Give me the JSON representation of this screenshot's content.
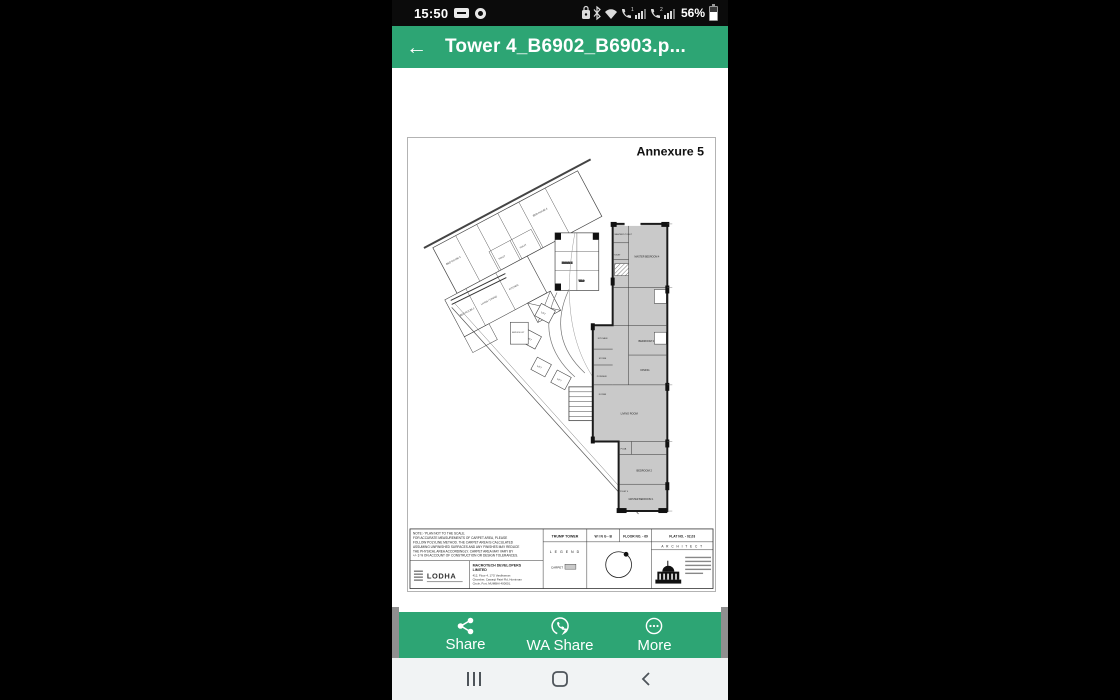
{
  "colors": {
    "accent_green": "#2da574",
    "plan_fill": "#c9c9c9"
  },
  "status_bar": {
    "time": "15:50",
    "battery": "56%",
    "sim1": "1",
    "sim2": "2"
  },
  "header": {
    "back_icon": "←",
    "title": "Tower 4_B6902_B6903.p..."
  },
  "action_bar": {
    "share": "Share",
    "wa_share": "WA Share",
    "more": "More"
  },
  "document": {
    "annexure": "Annexure 5",
    "note_lines": [
      "NOTE:- 'PLAN NOT TO THE SCALE.",
      "FOR ACCURATE MEASUREMENTS OF CARPET AREA, PLEASE",
      "FOLLOW POLYLINE METHOD. THE CARPET AREA IS CALCULATED",
      "ASSUMING UNFINISHED SURFACES AND ANY FINISHES MAY REDUCE",
      "THE PHYSICAL AREA ACCORDINGLY. CARPET AREA MAY VARY BY",
      "+/- 3 % ON ACCOUNT OF CONSTRUCTION OR DESIGN TOLERANCES."
    ],
    "title_block": {
      "project": "TRUMP TOWER",
      "wing": "W I N G - B",
      "floor": "FLOOR NO. - 69",
      "flat": "FLAT NO. -  02,03",
      "legend": "L E G E N D",
      "carpet": "CARPET",
      "architect": "A R C H I T E C T",
      "logo": "LODHA",
      "developer_1": "MACROTECH DEVELOPERS",
      "developer_2": "LIMITED",
      "address_1": "412, Floor 4, 17G Vardhaman",
      "address_2": "Chamber, Cawasji Patel Rd, Horniman",
      "address_3": "Circle, Fort, MUMBAI 400001."
    },
    "plan": {
      "bed_room_1": "BED ROOM 1",
      "bed_room_3": "BED ROOM 3",
      "bed_room_4": "BED ROOM 4",
      "toilet": "TOILET",
      "living_dining": "LIVING / DINING",
      "kitchen_left": "KITCHEN",
      "passage": "PASSAGE",
      "lift": "LIFT",
      "service_lift": "SERVICE LIFT",
      "wic": "W.I.C",
      "master_toilet": "MASTER'S TOILET",
      "master_bedroom_4": "MASTER BEDROOM 4",
      "bedroom_3": "BEDROOM 3",
      "dining": "DINING",
      "living_room": "LIVING ROOM",
      "kitchen": "KITCHEN",
      "store": "STORE",
      "powder": "POWDER",
      "foyer": "FOYER",
      "puja": "PUJA",
      "bedroom_2": "BEDROOM 2",
      "master_bedroom_1": "MASTER BEDROOM 1",
      "toilet_4": "TOILET 4"
    }
  }
}
